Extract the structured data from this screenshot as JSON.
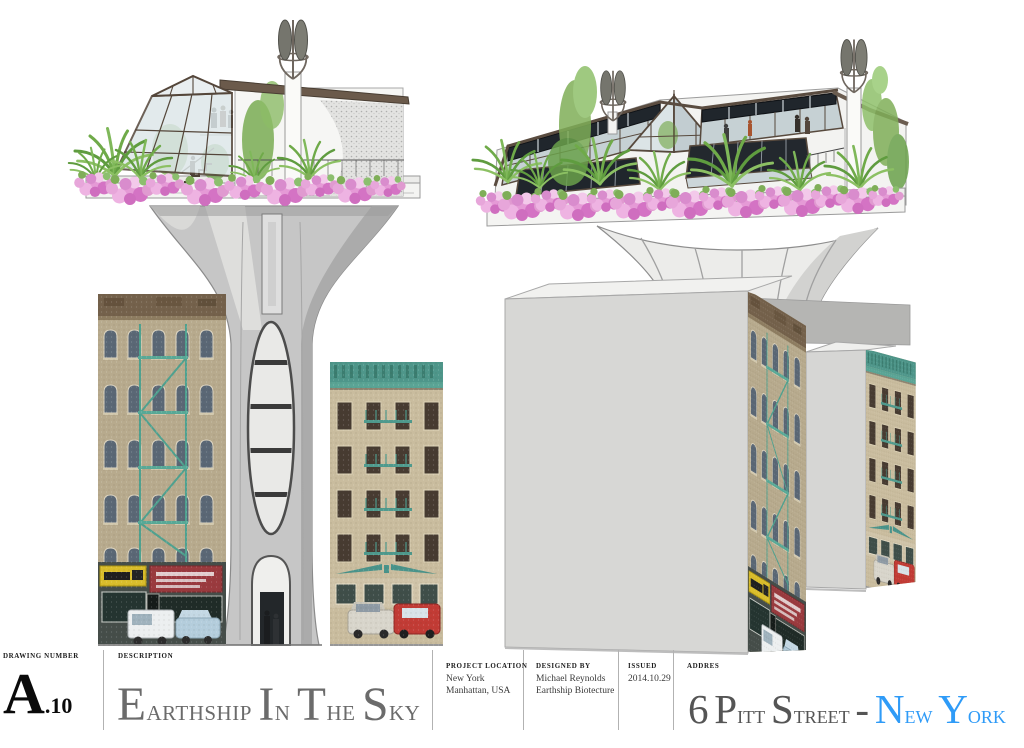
{
  "sheet": {
    "background_color": "#ffffff",
    "accent_blue": "#2f9bf7",
    "title_gray": "#6b6b6b",
    "drawing_number_color": "#0a0a0a"
  },
  "title_block": {
    "drawing_number": {
      "label": "DRAWING NUMBER",
      "value_letter": "A",
      "value_suffix": ".10"
    },
    "description": {
      "label": "DESCRIPTION",
      "value": "Earthship In The Sky"
    },
    "project_location": {
      "label": "PROJECT LOCATION",
      "line1": "New York",
      "line2": "Manhattan, USA"
    },
    "designed_by": {
      "label": "DESIGNED BY",
      "line1": "Michael Reynolds",
      "line2": "Earthship Biotecture"
    },
    "issued": {
      "label": "ISSUED",
      "value": "2014.10.29"
    },
    "address": {
      "label": "ADDRES",
      "value_main": "6 Pitt Street -",
      "value_highlight": "New York"
    }
  },
  "views": {
    "left": "street-elevation-of-earthship-tower",
    "right": "perspective-of-earthship-tower"
  }
}
